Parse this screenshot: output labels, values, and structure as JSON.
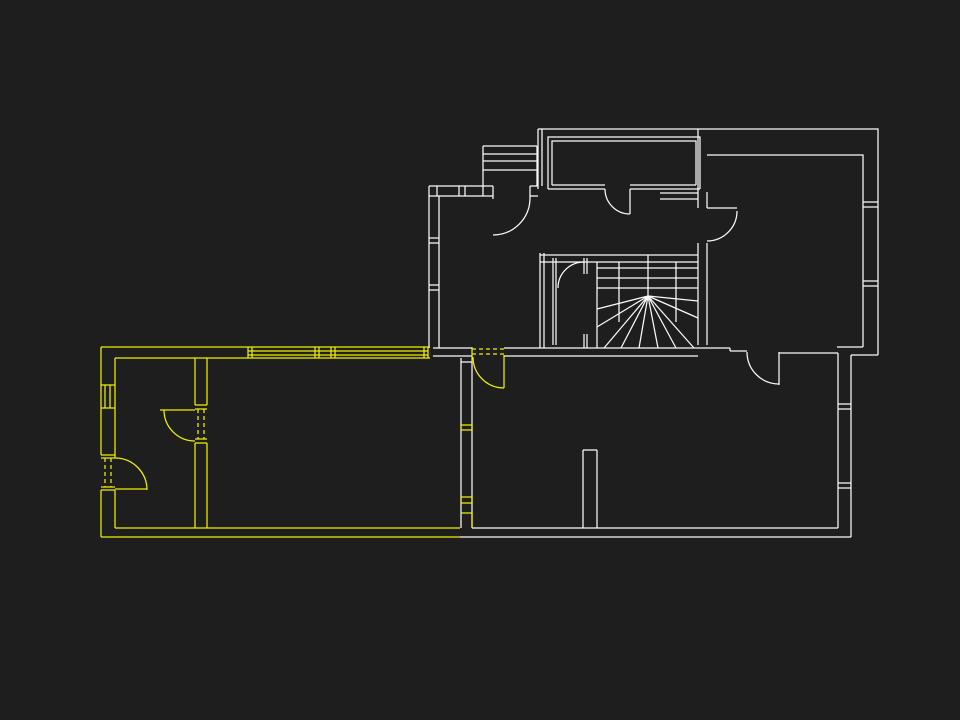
{
  "slide": {
    "title": "stávající dispozice"
  },
  "colors": {
    "background": "#1e1e1e",
    "plan_primary": "#fafaf8",
    "plan_highlight": "#f0f000",
    "title_text": "#f1f1ec"
  }
}
